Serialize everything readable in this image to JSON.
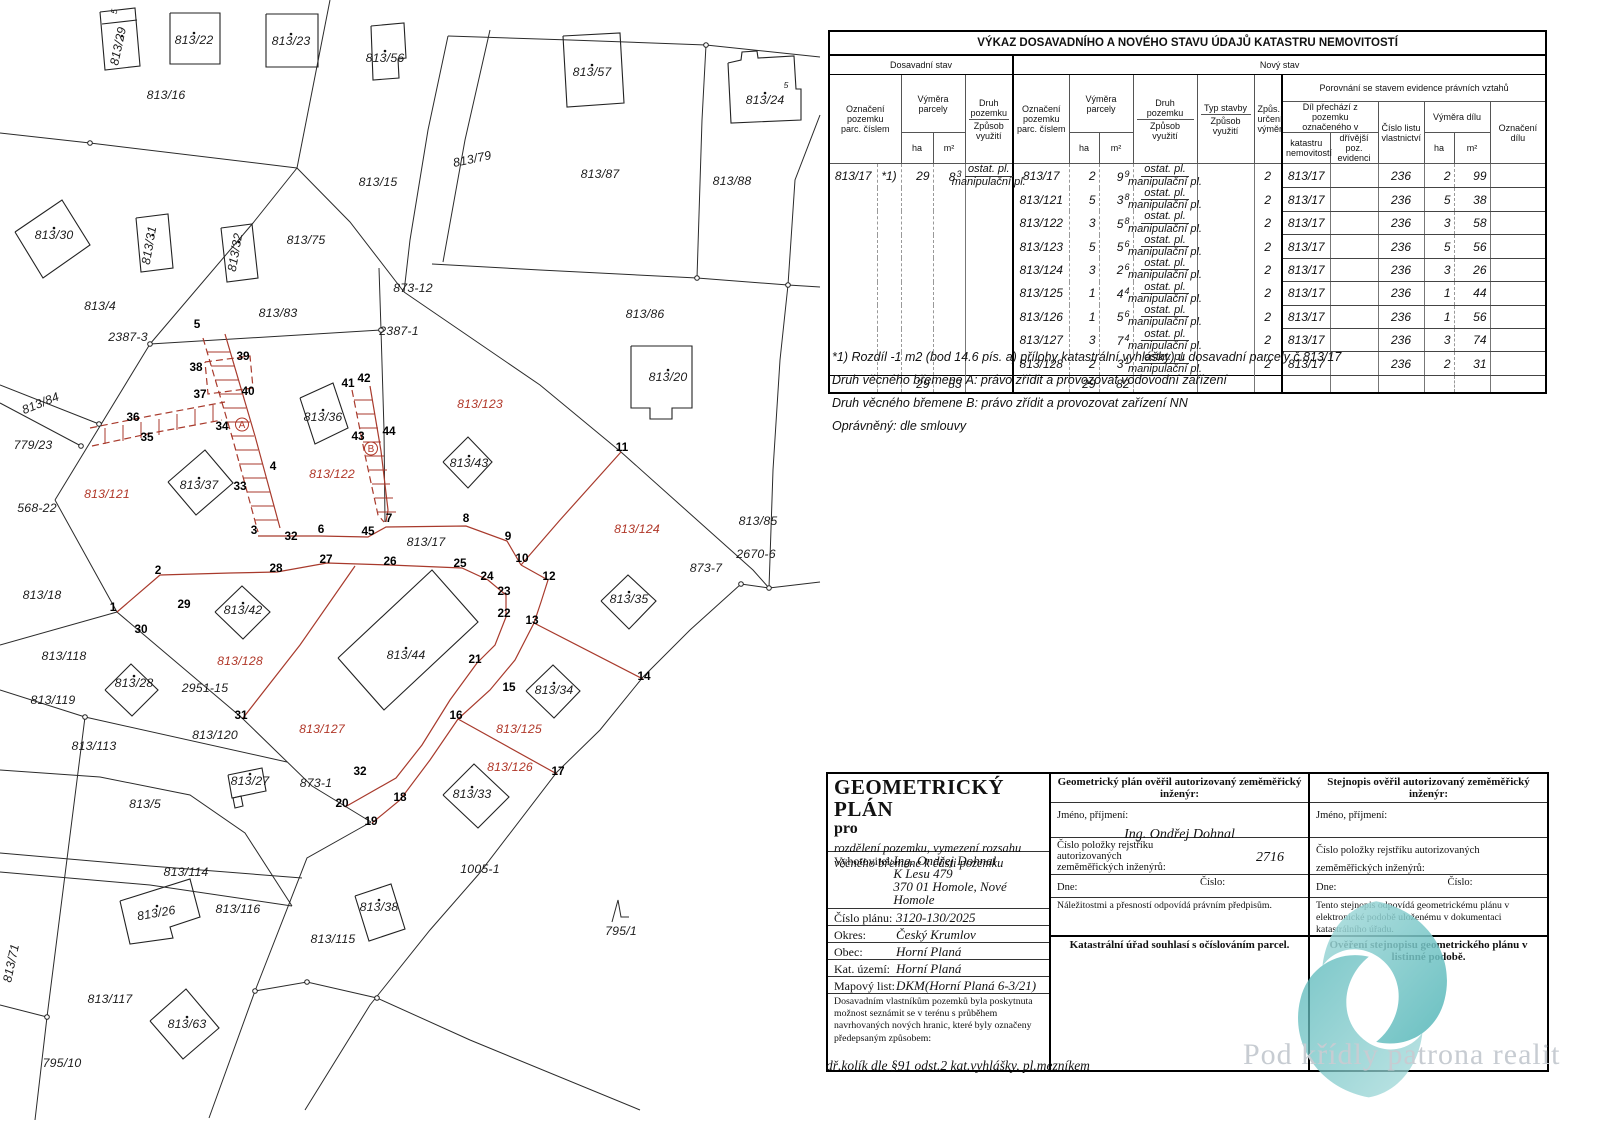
{
  "table": {
    "title": "VÝKAZ DOSAVADNÍHO A NOVÉHO STAVU ÚDAJŮ KATASTRU NEMOVITOSTÍ",
    "old_label": "Dosavadní stav",
    "new_label": "Nový stav",
    "h": {
      "oznaceni": "Označení\npozemku\nparc. číslem",
      "vymera": "Výměra parcely",
      "ha": "ha",
      "m2": "m²",
      "druh": "Druh pozemku",
      "zpusob": "Způsob využití",
      "typ": "Typ stavby",
      "zpus": "Způs.\nurčení\nvýměr",
      "porovnani": "Porovnání se stavem evidence právních vztahů",
      "dil": "Díl přechází z pozemku\noznačeného v",
      "katastru": "katastru\nnemovitostí",
      "drivejsi": "dřívější poz.\nevidenci",
      "lv": "Číslo listu\nvlastnictví",
      "vymera_dilu": "Výměra dílu",
      "oznaceni_dilu": "Označení\ndílu"
    },
    "druh_top": "ostat. pl.",
    "druh_bottom": "manipulační pl.",
    "rows": [
      {
        "op": "813/17",
        "on": "*1)",
        "oha": "29",
        "om": "8",
        "oms": "3",
        "odruh": true,
        "np": "813/17",
        "nha": "2",
        "nm": "9",
        "nms": "9",
        "zp": "2",
        "kat": "813/17",
        "lv": "236",
        "dha": "2",
        "dm": "99"
      },
      {
        "np": "813/121",
        "nha": "5",
        "nm": "3",
        "nms": "8",
        "zp": "2",
        "kat": "813/17",
        "lv": "236",
        "dha": "5",
        "dm": "38"
      },
      {
        "np": "813/122",
        "nha": "3",
        "nm": "5",
        "nms": "8",
        "zp": "2",
        "kat": "813/17",
        "lv": "236",
        "dha": "3",
        "dm": "58"
      },
      {
        "np": "813/123",
        "nha": "5",
        "nm": "5",
        "nms": "6",
        "zp": "2",
        "kat": "813/17",
        "lv": "236",
        "dha": "5",
        "dm": "56"
      },
      {
        "np": "813/124",
        "nha": "3",
        "nm": "2",
        "nms": "6",
        "zp": "2",
        "kat": "813/17",
        "lv": "236",
        "dha": "3",
        "dm": "26"
      },
      {
        "np": "813/125",
        "nha": "1",
        "nm": "4",
        "nms": "4",
        "zp": "2",
        "kat": "813/17",
        "lv": "236",
        "dha": "1",
        "dm": "44"
      },
      {
        "np": "813/126",
        "nha": "1",
        "nm": "5",
        "nms": "6",
        "zp": "2",
        "kat": "813/17",
        "lv": "236",
        "dha": "1",
        "dm": "56"
      },
      {
        "np": "813/127",
        "nha": "3",
        "nm": "7",
        "nms": "4",
        "zp": "2",
        "kat": "813/17",
        "lv": "236",
        "dha": "3",
        "dm": "74"
      },
      {
        "np": "813/128",
        "nha": "2",
        "nm": "3",
        "nms": "1",
        "zp": "2",
        "kat": "813/17",
        "lv": "236",
        "dha": "2",
        "dm": "31"
      }
    ],
    "totals": {
      "oha": "29",
      "om": "83",
      "nha": "29",
      "nm": "82"
    },
    "footnotes": [
      "*1) Rozdíl -1 m2 (bod 14.6 pís. a) přílohy katastrální vyhlášky) u dosavadní parcely č.813/17",
      "Druh věcného břemene A: právo zřídit a provozovat vodovodní zařízení",
      "Druh věcného břemene B: právo zřídit a provozovat zařízení NN",
      "Oprávněný: dle smlouvy"
    ]
  },
  "footer": {
    "plan": {
      "title": "GEOMETRICKÝ PLÁN",
      "pro": "pro",
      "subtitle": "rozdělení pozemku, vymezení rozsahu\nvěcného břemene k části pozemku"
    },
    "fields": [
      {
        "label": "Vyhotovitel:",
        "value": "Ing. Ondřej Dohnal\nK Lesu 479\n370 01  Homole, Nové Homole"
      },
      {
        "label": "Číslo plánu:",
        "value": "3120-130/2025"
      },
      {
        "label": "Okres:",
        "value": "Český Krumlov"
      },
      {
        "label": "Obec:",
        "value": "Horní Planá"
      },
      {
        "label": "Kat. území:",
        "value": "Horní Planá"
      },
      {
        "label": "Mapový list:",
        "value": "DKM(Horní Planá 6-3/21)"
      }
    ],
    "notice": "Dosavadním vlastníkům pozemků byla poskytnuta možnost seznámit se v terénu s průběhem navrhovaných nových hranic, které byly označeny předepsaným způsobem:",
    "notice_italic": "dř.kolík dle §91 odst.2 kat.vyhlášky, pl.mezníkem",
    "verify_plan": {
      "header": "Geometrický plán ověřil autorizovaný zeměměřický inženýr:",
      "name_label": "Jméno, příjmení:",
      "name_value": "Ing. Ondřej Dohnal",
      "reg_label": "Číslo položky rejstříku autorizovaných\nzeměměřických inženýrů:",
      "reg_value": "2716",
      "date_label": "Dne:",
      "number_label": "Číslo:",
      "note": "Náležitostmi a přesností odpovídá právním předpisům."
    },
    "verify_copy": {
      "header": "Stejnopis ověřil autorizovaný zeměměřický inženýr:",
      "name_label": "Jméno, příjmení:",
      "reg_label": "Číslo položky rejstříku autorizovaných\nzeměměřických inženýrů:",
      "date_label": "Dne:",
      "number_label": "Číslo:",
      "note": "Tento stejnopis odpovídá geometrickému plánu v elektronické podobě uloženému v dokumentaci katastrálního úřadu."
    },
    "cadastre_note": "Katastrální úřad souhlasí s očíslováním parcel.",
    "listinna": "Ověření stejnopisu geometrického plánu v listinné podobě.",
    "watermark": "Pod křídly patrona realit"
  },
  "map": {
    "colors": {
      "boundary": "#2b2b2b",
      "new_state": "#a83a2c",
      "red_label": "#b03728"
    },
    "labels": [
      {
        "t": "813/29",
        "x": 122,
        "y": 47,
        "c": "pb",
        "r": -78,
        "d": 1
      },
      {
        "t": "813/22",
        "x": 194,
        "y": 44,
        "c": "pb",
        "d": 1
      },
      {
        "t": "813/23",
        "x": 291,
        "y": 45,
        "c": "pb",
        "d": 1
      },
      {
        "t": "813/56",
        "x": 385,
        "y": 62,
        "c": "pb",
        "d": 1
      },
      {
        "t": "813/57",
        "x": 592,
        "y": 76,
        "c": "pb",
        "d": 1
      },
      {
        "t": "813/24",
        "x": 765,
        "y": 104,
        "c": "pb",
        "d": 1
      },
      {
        "t": "5",
        "x": 117,
        "y": 12,
        "c": "sm",
        "r": -80
      },
      {
        "t": "5",
        "x": 786,
        "y": 88,
        "c": "sm"
      },
      {
        "t": "813/16",
        "x": 166,
        "y": 99,
        "c": "pb"
      },
      {
        "t": "813/79",
        "x": 473,
        "y": 163,
        "c": "pb",
        "r": -12
      },
      {
        "t": "813/15",
        "x": 378,
        "y": 186,
        "c": "pb"
      },
      {
        "t": "813/87",
        "x": 600,
        "y": 178,
        "c": "pb"
      },
      {
        "t": "813/88",
        "x": 732,
        "y": 185,
        "c": "pb"
      },
      {
        "t": "813/30",
        "x": 54,
        "y": 239,
        "c": "pb",
        "d": 1
      },
      {
        "t": "813/31",
        "x": 153,
        "y": 246,
        "c": "pb",
        "r": -80,
        "d": 1
      },
      {
        "t": "813/32",
        "x": 239,
        "y": 253,
        "c": "pb",
        "r": -80,
        "d": 1
      },
      {
        "t": "813/75",
        "x": 306,
        "y": 244,
        "c": "pb"
      },
      {
        "t": "813/4",
        "x": 100,
        "y": 310,
        "c": "pb"
      },
      {
        "t": "813/83",
        "x": 278,
        "y": 317,
        "c": "pb"
      },
      {
        "t": "873-12",
        "x": 413,
        "y": 292,
        "c": "pb"
      },
      {
        "t": "2387-3",
        "x": 128,
        "y": 341,
        "c": "pb"
      },
      {
        "t": "2387-1",
        "x": 399,
        "y": 335,
        "c": "pb"
      },
      {
        "t": "813/86",
        "x": 645,
        "y": 318,
        "c": "pb"
      },
      {
        "t": "813/20",
        "x": 668,
        "y": 381,
        "c": "pb",
        "d": 1
      },
      {
        "t": "813/84",
        "x": 42,
        "y": 407,
        "c": "pb",
        "r": -22
      },
      {
        "t": "779/23",
        "x": 33,
        "y": 449,
        "c": "pb"
      },
      {
        "t": "813/36",
        "x": 323,
        "y": 421,
        "c": "pb",
        "d": 1
      },
      {
        "t": "813/43",
        "x": 469,
        "y": 467,
        "c": "pb",
        "d": 1
      },
      {
        "t": "813/37",
        "x": 199,
        "y": 489,
        "c": "pb",
        "d": 1
      },
      {
        "t": "568-22",
        "x": 37,
        "y": 512,
        "c": "pb"
      },
      {
        "t": "813/17",
        "x": 426,
        "y": 546,
        "c": "pb"
      },
      {
        "t": "813/85",
        "x": 758,
        "y": 525,
        "c": "pb"
      },
      {
        "t": "2670-6",
        "x": 756,
        "y": 558,
        "c": "pb"
      },
      {
        "t": "873-7",
        "x": 706,
        "y": 572,
        "c": "pb"
      },
      {
        "t": "813/18",
        "x": 42,
        "y": 599,
        "c": "pb"
      },
      {
        "t": "813/35",
        "x": 629,
        "y": 603,
        "c": "pb",
        "d": 1
      },
      {
        "t": "813/42",
        "x": 243,
        "y": 614,
        "c": "pb",
        "d": 1
      },
      {
        "t": "813/118",
        "x": 64,
        "y": 660,
        "c": "pb"
      },
      {
        "t": "813/44",
        "x": 406,
        "y": 659,
        "c": "pb",
        "d": 1
      },
      {
        "t": "813/28",
        "x": 134,
        "y": 687,
        "c": "pb",
        "d": 1
      },
      {
        "t": "2951-15",
        "x": 205,
        "y": 692,
        "c": "pb"
      },
      {
        "t": "813/119",
        "x": 53,
        "y": 704,
        "c": "pb"
      },
      {
        "t": "813/34",
        "x": 554,
        "y": 694,
        "c": "pb",
        "d": 1
      },
      {
        "t": "813/120",
        "x": 215,
        "y": 739,
        "c": "pb"
      },
      {
        "t": "813/113",
        "x": 94,
        "y": 750,
        "c": "pb"
      },
      {
        "t": "813/27",
        "x": 250,
        "y": 785,
        "c": "pb",
        "d": 1
      },
      {
        "t": "873-1",
        "x": 316,
        "y": 787,
        "c": "pb"
      },
      {
        "t": "813/5",
        "x": 145,
        "y": 808,
        "c": "pb"
      },
      {
        "t": "813/33",
        "x": 472,
        "y": 798,
        "c": "pb",
        "d": 1
      },
      {
        "t": "1005-1",
        "x": 480,
        "y": 873,
        "c": "pb"
      },
      {
        "t": "813/114",
        "x": 186,
        "y": 876,
        "c": "pb"
      },
      {
        "t": "813/26",
        "x": 157,
        "y": 917,
        "c": "pb",
        "r": -10,
        "d": 1
      },
      {
        "t": "813/116",
        "x": 238,
        "y": 913,
        "c": "pb"
      },
      {
        "t": "813/38",
        "x": 379,
        "y": 911,
        "c": "pb",
        "d": 1
      },
      {
        "t": "813/115",
        "x": 333,
        "y": 943,
        "c": "pb"
      },
      {
        "t": "795/1",
        "x": 621,
        "y": 935,
        "c": "pb"
      },
      {
        "t": "813/71",
        "x": 15,
        "y": 964,
        "c": "pb",
        "r": -78
      },
      {
        "t": "813/117",
        "x": 110,
        "y": 1003,
        "c": "pb"
      },
      {
        "t": "813/63",
        "x": 187,
        "y": 1028,
        "c": "pb",
        "d": 1
      },
      {
        "t": "795/10",
        "x": 62,
        "y": 1067,
        "c": "pb"
      },
      {
        "t": "813/121",
        "x": 107,
        "y": 498,
        "c": "pr"
      },
      {
        "t": "813/122",
        "x": 332,
        "y": 478,
        "c": "pr"
      },
      {
        "t": "813/123",
        "x": 480,
        "y": 408,
        "c": "pr"
      },
      {
        "t": "813/124",
        "x": 637,
        "y": 533,
        "c": "pr"
      },
      {
        "t": "813/128",
        "x": 240,
        "y": 665,
        "c": "pr"
      },
      {
        "t": "813/127",
        "x": 322,
        "y": 733,
        "c": "pr"
      },
      {
        "t": "813/125",
        "x": 519,
        "y": 733,
        "c": "pr"
      },
      {
        "t": "813/126",
        "x": 510,
        "y": 771,
        "c": "pr"
      },
      {
        "t": "1",
        "x": 113,
        "y": 611,
        "c": "pt"
      },
      {
        "t": "2",
        "x": 158,
        "y": 574,
        "c": "pt"
      },
      {
        "t": "3",
        "x": 254,
        "y": 534,
        "c": "pt"
      },
      {
        "t": "4",
        "x": 273,
        "y": 470,
        "c": "pt"
      },
      {
        "t": "5",
        "x": 197,
        "y": 328,
        "c": "pt"
      },
      {
        "t": "6",
        "x": 321,
        "y": 533,
        "c": "pt"
      },
      {
        "t": "7",
        "x": 389,
        "y": 522,
        "c": "pt"
      },
      {
        "t": "8",
        "x": 466,
        "y": 522,
        "c": "pt"
      },
      {
        "t": "9",
        "x": 508,
        "y": 540,
        "c": "pt"
      },
      {
        "t": "10",
        "x": 522,
        "y": 562,
        "c": "pt"
      },
      {
        "t": "11",
        "x": 622,
        "y": 451,
        "c": "pt"
      },
      {
        "t": "12",
        "x": 549,
        "y": 580,
        "c": "pt"
      },
      {
        "t": "13",
        "x": 532,
        "y": 624,
        "c": "pt"
      },
      {
        "t": "14",
        "x": 644,
        "y": 680,
        "c": "pt"
      },
      {
        "t": "15",
        "x": 509,
        "y": 691,
        "c": "pt"
      },
      {
        "t": "16",
        "x": 456,
        "y": 719,
        "c": "pt"
      },
      {
        "t": "17",
        "x": 558,
        "y": 775,
        "c": "pt"
      },
      {
        "t": "18",
        "x": 400,
        "y": 801,
        "c": "pt"
      },
      {
        "t": "19",
        "x": 371,
        "y": 825,
        "c": "pt"
      },
      {
        "t": "20",
        "x": 342,
        "y": 807,
        "c": "pt"
      },
      {
        "t": "21",
        "x": 475,
        "y": 663,
        "c": "pt"
      },
      {
        "t": "22",
        "x": 504,
        "y": 617,
        "c": "pt"
      },
      {
        "t": "23",
        "x": 504,
        "y": 595,
        "c": "pt"
      },
      {
        "t": "24",
        "x": 487,
        "y": 580,
        "c": "pt"
      },
      {
        "t": "25",
        "x": 460,
        "y": 567,
        "c": "pt"
      },
      {
        "t": "26",
        "x": 390,
        "y": 565,
        "c": "pt"
      },
      {
        "t": "27",
        "x": 326,
        "y": 563,
        "c": "pt"
      },
      {
        "t": "28",
        "x": 276,
        "y": 572,
        "c": "pt"
      },
      {
        "t": "29",
        "x": 184,
        "y": 608,
        "c": "pt"
      },
      {
        "t": "30",
        "x": 141,
        "y": 633,
        "c": "pt"
      },
      {
        "t": "31",
        "x": 241,
        "y": 719,
        "c": "pt"
      },
      {
        "t": "32",
        "x": 291,
        "y": 540,
        "c": "pt"
      },
      {
        "t": "32",
        "x": 360,
        "y": 775,
        "c": "pt"
      },
      {
        "t": "33",
        "x": 240,
        "y": 490,
        "c": "pt"
      },
      {
        "t": "34",
        "x": 222,
        "y": 430,
        "c": "pt"
      },
      {
        "t": "35",
        "x": 147,
        "y": 441,
        "c": "pt"
      },
      {
        "t": "36",
        "x": 133,
        "y": 421,
        "c": "pt"
      },
      {
        "t": "37",
        "x": 200,
        "y": 398,
        "c": "pt"
      },
      {
        "t": "38",
        "x": 196,
        "y": 371,
        "c": "pt"
      },
      {
        "t": "39",
        "x": 243,
        "y": 360,
        "c": "pt"
      },
      {
        "t": "40",
        "x": 248,
        "y": 395,
        "c": "pt"
      },
      {
        "t": "41",
        "x": 348,
        "y": 387,
        "c": "pt"
      },
      {
        "t": "42",
        "x": 364,
        "y": 382,
        "c": "pt"
      },
      {
        "t": "43",
        "x": 358,
        "y": 440,
        "c": "pt"
      },
      {
        "t": "44",
        "x": 389,
        "y": 435,
        "c": "pt"
      },
      {
        "t": "45",
        "x": 368,
        "y": 535,
        "c": "pt"
      },
      {
        "t": "A",
        "x": 242,
        "y": 428,
        "c": "lt"
      },
      {
        "t": "B",
        "x": 371,
        "y": 452,
        "c": "lt"
      }
    ]
  }
}
